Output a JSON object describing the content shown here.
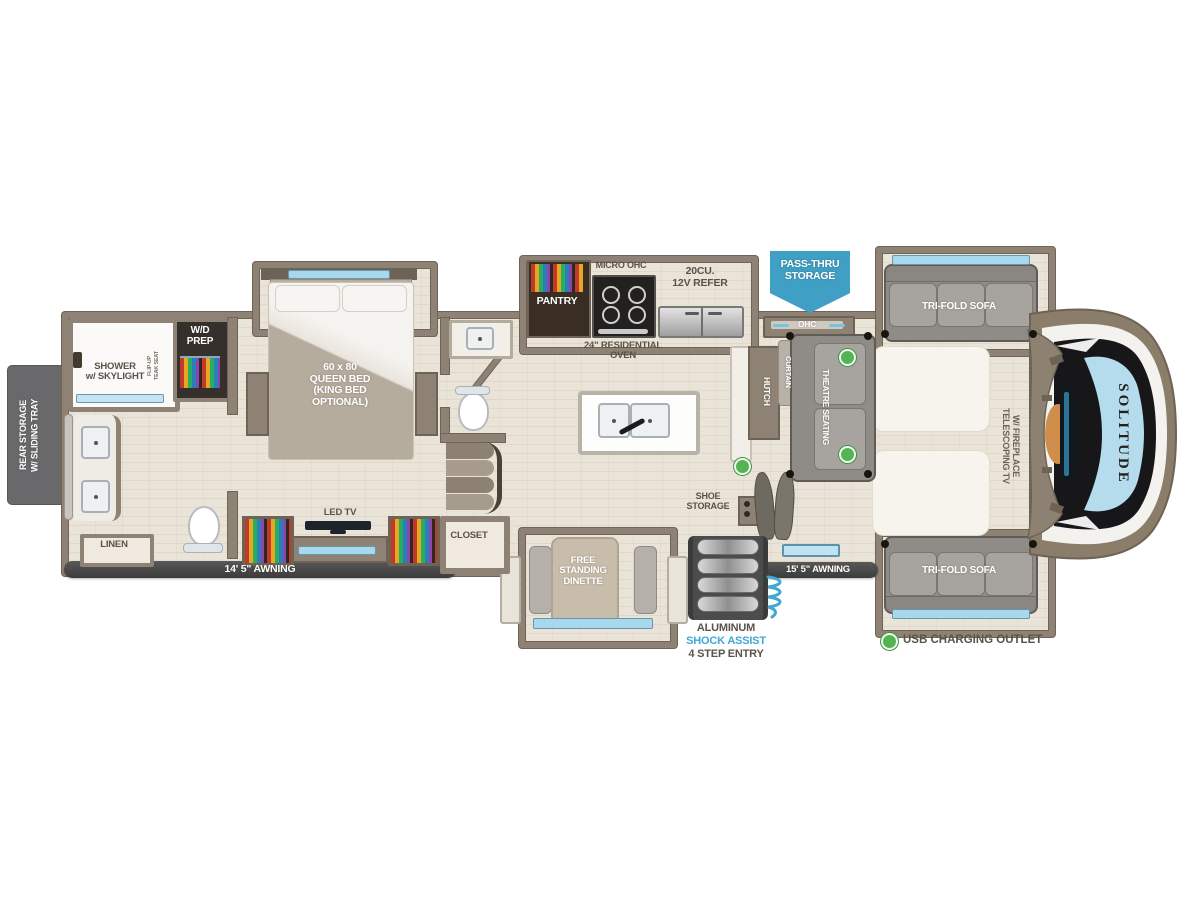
{
  "labels": {
    "rear_storage": "REAR STORAGE\nW/ SLIDING TRAY",
    "shower": "SHOWER\nw/ SKYLIGHT",
    "flip_seat": "FLIP-UP\nTEAK SEAT",
    "wd_prep": "W/D\nPREP",
    "linen": "LINEN",
    "awning_rear": "14' 5\" AWNING",
    "queen_bed": "60 x 80\nQUEEN BED\n(KING BED\nOPTIONAL)",
    "led_tv": "LED TV",
    "closet": "CLOSET",
    "pantry": "PANTRY",
    "micro_ohc": "MICRO OHC",
    "refer": "20CU.\n12V REFER",
    "oven": "24\" RESIDENTIAL\nOVEN",
    "pass_thru": "PASS-THRU\nSTORAGE",
    "ohc": "OHC",
    "hutch": "HUTCH",
    "curtain": "CURTAIN",
    "theatre": "THEATRE SEATING",
    "sofa_top": "TRI-FOLD SOFA",
    "sofa_bottom": "TRI-FOLD SOFA",
    "telescoping_tv": "TELESCOPING TV\nW/ FIREPLACE",
    "brand": "SOLITUDE",
    "shoe_storage": "SHOE\nSTORAGE",
    "awning_front": "15' 5\" AWNING",
    "entry_line1": "ALUMINUM",
    "entry_line2": "SHOCK ASSIST",
    "entry_line3": "4 STEP ENTRY",
    "dinette": "FREE\nSTANDING\nDINETTE"
  },
  "legend": {
    "usb": "USB CHARGING OUTLET"
  },
  "usb_outlets": [
    {
      "x": 847,
      "y": 357
    },
    {
      "x": 847,
      "y": 454
    },
    {
      "x": 742,
      "y": 466
    }
  ],
  "colors": {
    "wall": "#8d8273",
    "floor": "#eae3d7",
    "banner_blue": "#3f9fc4",
    "shock_assist_blue": "#3fa8d4",
    "awning_bar": "#454545",
    "usb_green": "#54b455",
    "label_text": "#5b5348",
    "window_blue": "#a8d8ec"
  }
}
